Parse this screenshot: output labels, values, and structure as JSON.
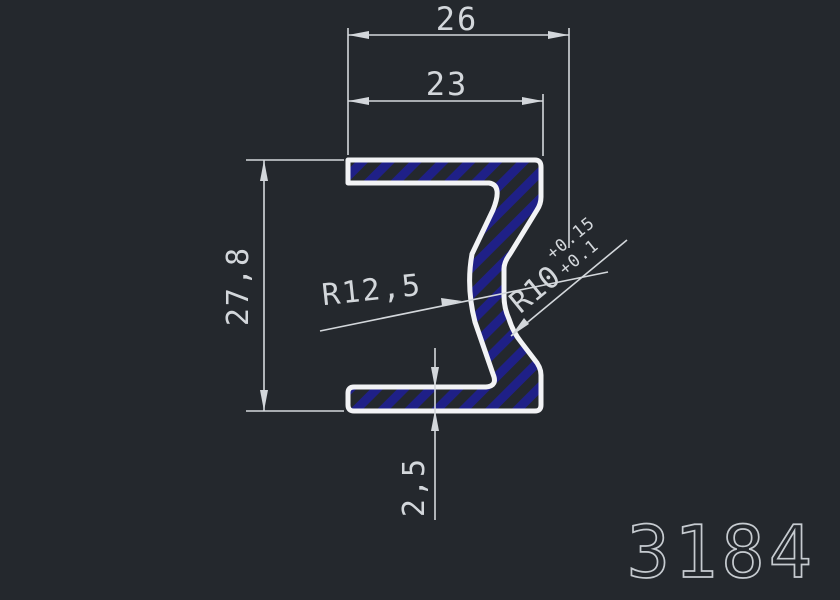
{
  "drawing": {
    "part_number": "3184",
    "dimensions": {
      "overall_width": "26",
      "opening_width": "23",
      "overall_height": "27,8",
      "flange_thickness": "2,5",
      "inner_radius": "R12,5",
      "notch_radius": "R10",
      "notch_radius_tol_upper": "+0.15",
      "notch_radius_tol_lower": "+0.1"
    },
    "colors": {
      "bg": "#24282d",
      "outline": "#f2f3f5",
      "hatch": "#1f2087",
      "dim": "#d3d7db",
      "part": "#c6cbd0"
    }
  }
}
